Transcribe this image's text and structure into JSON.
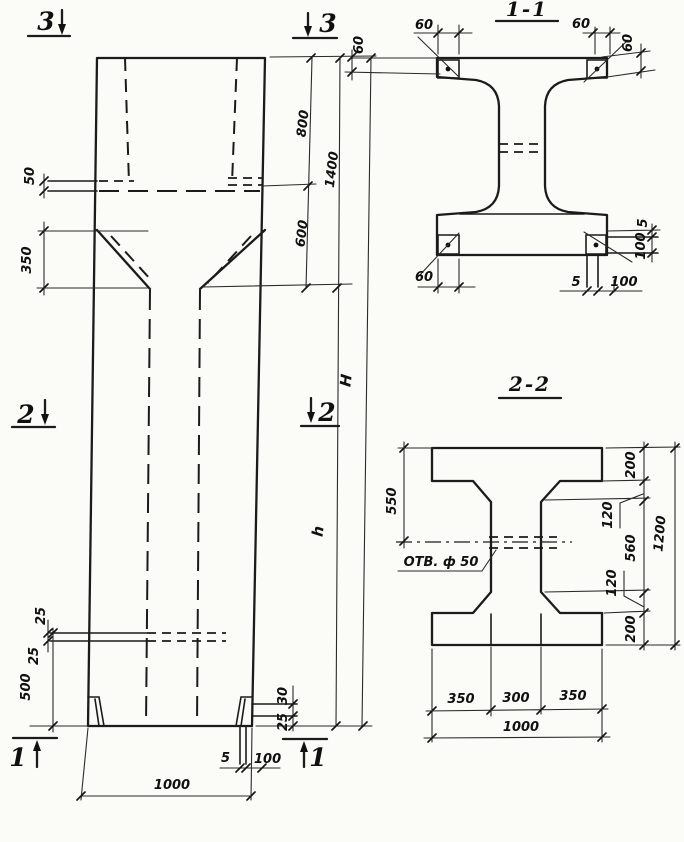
{
  "marks": {
    "top_left": "3",
    "top_right": "3",
    "mid_left": "2",
    "mid_right": "2",
    "bottom_left": "1",
    "bottom_right": "1"
  },
  "elevation": {
    "d50": "50",
    "d350": "350",
    "d800": "800",
    "d1400": "1400",
    "d600": "600",
    "dH": "H",
    "dh": "h",
    "d25_top": "25",
    "d25_bottom": "25",
    "d500": "500",
    "d30_foot": "30",
    "d25_foot": "25",
    "d5_base": "5",
    "d100_base": "100",
    "d1000": "1000"
  },
  "section11": {
    "title": "1-1",
    "d60_top_left_w": "60",
    "d60_top_left_h": "60",
    "d60_top_right_w": "60",
    "d60_top_right_h": "60",
    "d60_bottom_left": "60",
    "d5_bottom": "5",
    "d100_bottom": "100",
    "d5_right": "5",
    "d100_right": "100"
  },
  "section22": {
    "title": "2-2",
    "d550": "550",
    "hole_label": "ОТВ. ф 50",
    "d200_top": "200",
    "d120_top": "120",
    "d560": "560",
    "d120_bottom": "120",
    "d200_bottom": "200",
    "d1200": "1200",
    "d350_left": "350",
    "d300": "300",
    "d350_right": "350",
    "d1000": "1000"
  }
}
